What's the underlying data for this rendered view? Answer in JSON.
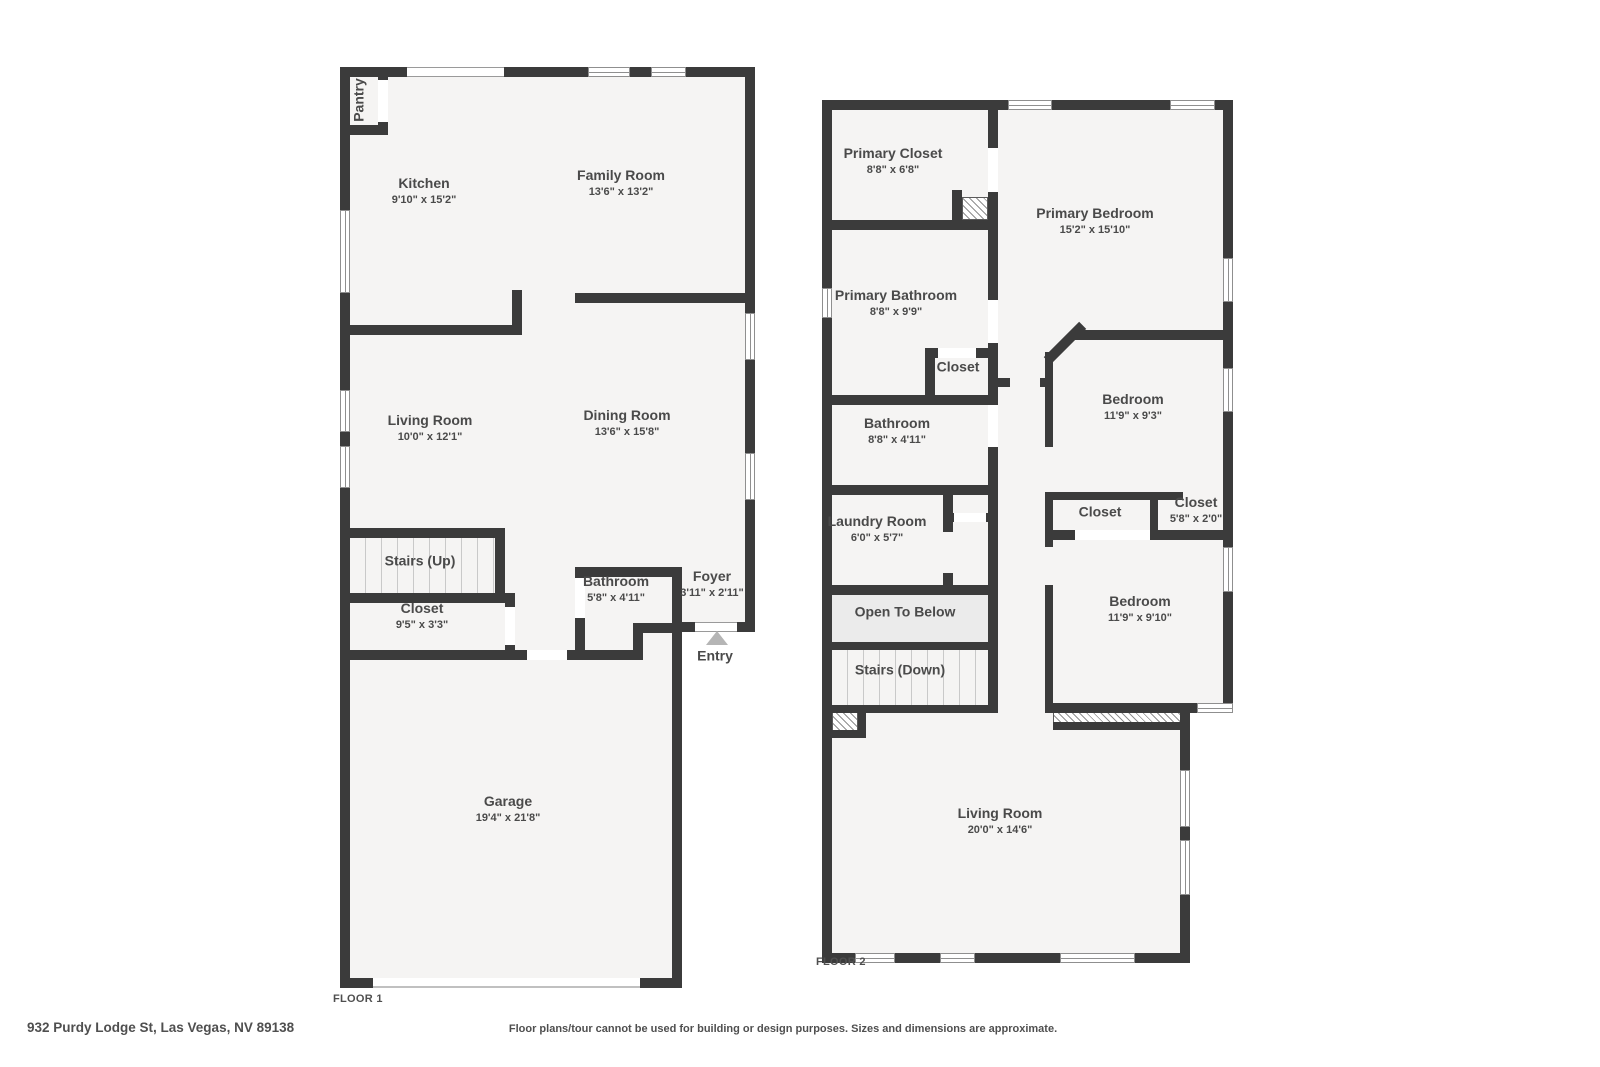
{
  "title_labels": {
    "floor1": "FLOOR 1",
    "floor2": "FLOOR 2"
  },
  "footer": {
    "address": "932 Purdy Lodge St, Las Vegas, NV 89138",
    "disclaimer": "Floor plans/tour cannot be used for building or design purposes. Sizes and dimensions are approximate."
  },
  "floor1": {
    "pantry": {
      "name": "Pantry"
    },
    "kitchen": {
      "name": "Kitchen",
      "dims": "9'10\" x 15'2\""
    },
    "family_room": {
      "name": "Family Room",
      "dims": "13'6\" x 13'2\""
    },
    "living_room": {
      "name": "Living Room",
      "dims": "10'0\" x 12'1\""
    },
    "dining_room": {
      "name": "Dining Room",
      "dims": "13'6\" x 15'8\""
    },
    "stairs": {
      "name": "Stairs (Up)"
    },
    "closet": {
      "name": "Closet",
      "dims": "9'5\" x 3'3\""
    },
    "bathroom": {
      "name": "Bathroom",
      "dims": "5'8\" x 4'11\""
    },
    "foyer": {
      "name": "Foyer",
      "dims": "3'11\" x 2'11\""
    },
    "entry": {
      "name": "Entry"
    },
    "garage": {
      "name": "Garage",
      "dims": "19'4\" x 21'8\""
    }
  },
  "floor2": {
    "primary_closet": {
      "name": "Primary Closet",
      "dims": "8'8\" x 6'8\""
    },
    "primary_bedroom": {
      "name": "Primary Bedroom",
      "dims": "15'2\" x 15'10\""
    },
    "primary_bathroom": {
      "name": "Primary Bathroom",
      "dims": "8'8\" x 9'9\""
    },
    "hall_closet": {
      "name": "Closet"
    },
    "bathroom": {
      "name": "Bathroom",
      "dims": "8'8\" x 4'11\""
    },
    "laundry_room": {
      "name": "Laundry Room",
      "dims": "6'0\" x 5'7\""
    },
    "open_to_below": {
      "name": "Open To Below"
    },
    "stairs": {
      "name": "Stairs (Down)"
    },
    "bedroom_1": {
      "name": "Bedroom",
      "dims": "11'9\" x 9'3\""
    },
    "closet_1": {
      "name": "Closet"
    },
    "closet_2": {
      "name": "Closet",
      "dims": "5'8\" x 2'0\""
    },
    "bedroom_2": {
      "name": "Bedroom",
      "dims": "11'9\" x 9'10\""
    },
    "living_room": {
      "name": "Living Room",
      "dims": "20'0\" x 14'6\""
    }
  },
  "colors": {
    "wall": "#3b3b3b",
    "floor": "#f5f4f3",
    "open_to_below_fill": "#ebebeb",
    "entry_arrow": "#b5b5b5",
    "label_text": "#4a4a4a"
  }
}
